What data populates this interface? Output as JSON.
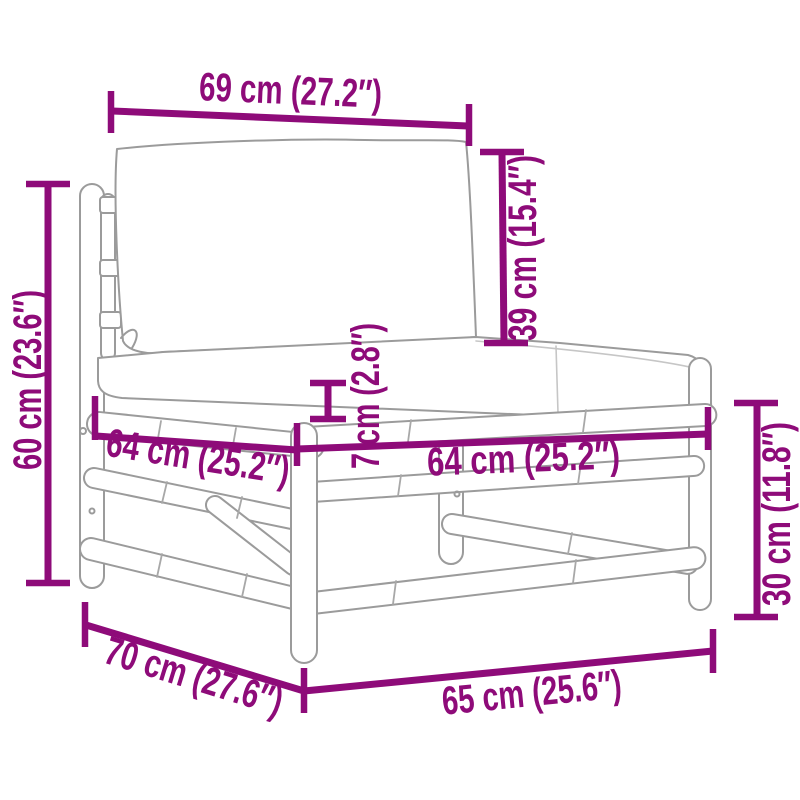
{
  "diagram": {
    "type": "product-dimension-diagram",
    "subject": "bamboo garden middle sofa with back and seat cushions",
    "accent_color": "#8E0B79",
    "line_color": "#9B9B9B",
    "background_color": "#FFFFFF",
    "dimensions": [
      {
        "id": "back-cushion-width",
        "label": "69 cm (27.2″)",
        "value_cm": 69,
        "value_in": 27.2
      },
      {
        "id": "back-cushion-height",
        "label": "39 cm (15.4″)",
        "value_cm": 39,
        "value_in": 15.4
      },
      {
        "id": "overall-height",
        "label": "60 cm (23.6″)",
        "value_cm": 60,
        "value_in": 23.6
      },
      {
        "id": "seat-cushion-thickness",
        "label": "7 cm (2.8″)",
        "value_cm": 7,
        "value_in": 2.8
      },
      {
        "id": "seat-side-length",
        "label": "64 cm (25.2″)",
        "value_cm": 64,
        "value_in": 25.2
      },
      {
        "id": "seat-front-length",
        "label": "64 cm (25.2″)",
        "value_cm": 64,
        "value_in": 25.2
      },
      {
        "id": "frame-height",
        "label": "30 cm (11.8″)",
        "value_cm": 30,
        "value_in": 11.8
      },
      {
        "id": "overall-depth",
        "label": "70 cm (27.6″)",
        "value_cm": 70,
        "value_in": 27.6
      },
      {
        "id": "overall-width",
        "label": "65 cm (25.6″)",
        "value_cm": 65,
        "value_in": 25.6
      }
    ]
  }
}
